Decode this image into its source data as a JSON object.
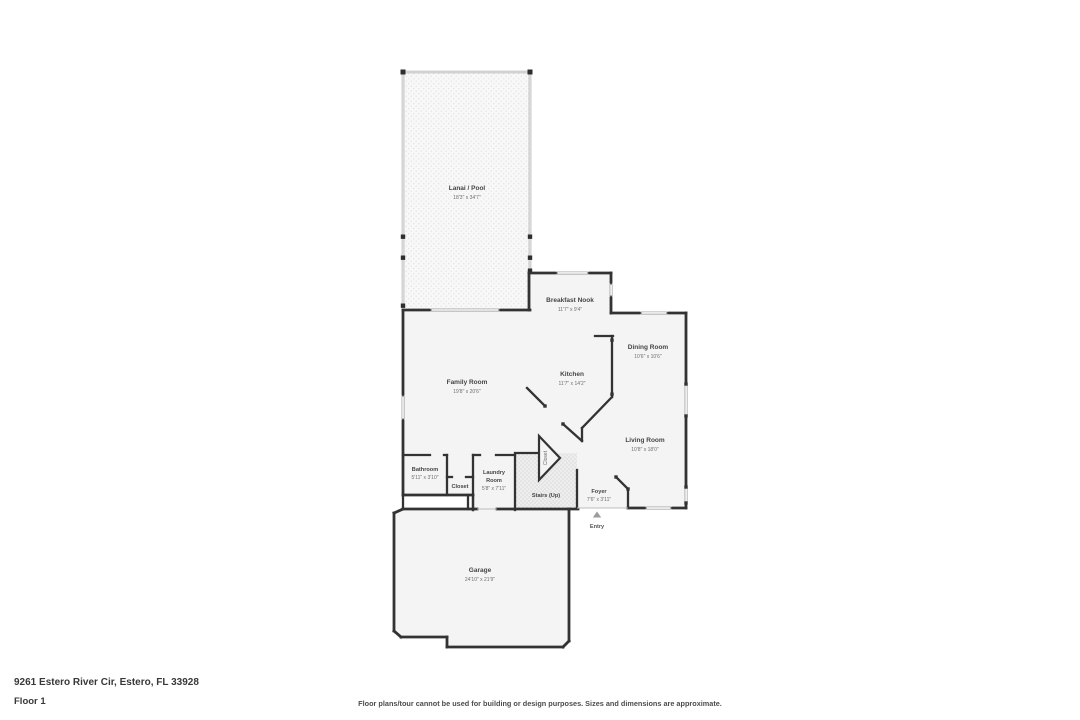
{
  "address": "9261 Estero River Cir, Estero, FL 33928",
  "floor_label": "Floor 1",
  "disclaimer": "Floor plans/tour cannot be used for building or design purposes. Sizes and dimensions are approximate.",
  "entry_label": "Entry",
  "rooms": {
    "lanai": {
      "name": "Lanai / Pool",
      "dims": "18'3\" x 34'7\""
    },
    "nook": {
      "name": "Breakfast Nook",
      "dims": "11'7\" x 9'4\""
    },
    "dining": {
      "name": "Dining Room",
      "dims": "10'6\" x 10'6\""
    },
    "kitchen": {
      "name": "Kitchen",
      "dims": "11'7\" x 14'2\""
    },
    "family": {
      "name": "Family Room",
      "dims": "19'8\" x 20'6\""
    },
    "living": {
      "name": "Living Room",
      "dims": "10'8\" x 18'0\""
    },
    "bathroom": {
      "name": "Bathroom",
      "dims": "5'11\" x 3'10\""
    },
    "closet_hall": {
      "name": "Closet"
    },
    "closet_stairs": {
      "name": "Closet"
    },
    "laundry": {
      "name_line1": "Laundry",
      "name_line2": "Room",
      "dims": "5'8\" x 7'11\""
    },
    "stairs": {
      "name": "Stairs (Up)"
    },
    "foyer": {
      "name": "Foyer",
      "dims": "7'6\" x 3'11\""
    },
    "garage": {
      "name": "Garage",
      "dims": "24'10\" x 21'9\""
    }
  },
  "colors": {
    "wall": "#333333",
    "room_fill": "#f4f4f4",
    "screen_wall": "#ababab",
    "lanai_fill": "#f8f8f8",
    "stairs_fill": "#eeeeee",
    "text_primary": "#383838"
  }
}
